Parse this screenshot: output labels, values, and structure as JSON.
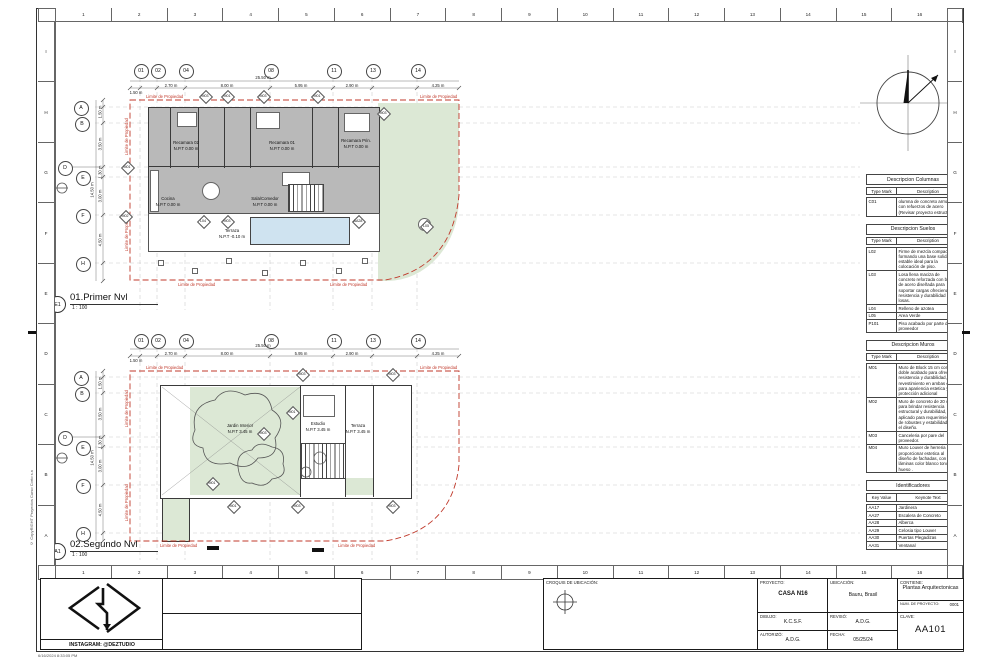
{
  "sheet": {
    "ruler_numbers": [
      "1",
      "2",
      "3",
      "4",
      "5",
      "6",
      "7",
      "8",
      "9",
      "10",
      "11",
      "12",
      "13",
      "14",
      "15",
      "16"
    ],
    "ruler_letters": [
      "I",
      "H",
      "G",
      "F",
      "E",
      "D",
      "C",
      "B",
      "A"
    ],
    "copyright": "© CopyRIGHT Proyectos Curso Corto s.n",
    "timestamp": "6/16/2024 8:33:05 PM"
  },
  "plan1": {
    "ref": "E1",
    "title": "01.Primer Nvl",
    "scale": "1 : 100",
    "cols": [
      "01",
      "02",
      "04",
      "08",
      "11",
      "13",
      "14"
    ],
    "rows": [
      "A",
      "B",
      "D",
      "E",
      "F",
      "H"
    ],
    "dims_top": [
      "1.50 m",
      "2.70 m",
      "8.00 m",
      "5.95 m",
      "2.90 m",
      "4.25 m"
    ],
    "dim_top_total": "25.50 m",
    "dims_left": [
      "1.50 m",
      "3.50 m",
      "1.30 m",
      "3.00 m",
      "4.50 m"
    ],
    "dim_left_total": "14.50 m",
    "property_label": "Limite de Propiedad",
    "rooms": [
      {
        "name": "Recamara 02",
        "level": "N.P.T 0.00 m"
      },
      {
        "name": "Recamara 01",
        "level": "N.P.T 0.00 m"
      },
      {
        "name": "Recamara Prin.",
        "level": "N.P.T 0.00 m"
      },
      {
        "name": "Cocina",
        "level": "N.P.T 0.00 m"
      },
      {
        "name": "Sala/Comedor",
        "level": "N.P.T 0.00 m"
      },
      {
        "name": "Terraza",
        "level": "N.P.T -0.10 m"
      }
    ],
    "tags": [
      "M03",
      "M01",
      "M03",
      "M01",
      "M03",
      "M01",
      "M02",
      "L04",
      "M03",
      "AA28",
      "L05"
    ]
  },
  "plan2": {
    "ref": "A1",
    "title": "02.Segundo Nvl",
    "scale": "1 : 100",
    "cols": [
      "01",
      "02",
      "04",
      "08",
      "11",
      "13",
      "14"
    ],
    "rows": [
      "A",
      "B",
      "D",
      "E",
      "F",
      "H"
    ],
    "dims_top": [
      "1.50 m",
      "2.70 m",
      "8.00 m",
      "5.95 m",
      "2.90 m",
      "4.25 m"
    ],
    "dim_top_total": "25.50 m",
    "dims_left": [
      "1.50 m",
      "3.50 m",
      "1.30 m",
      "3.00 m",
      "4.50 m"
    ],
    "dim_left_total": "14.50 m",
    "property_label": "Limite de Propiedad",
    "rooms": [
      {
        "name": "Jardin Interior",
        "level": "N.P.T 3.45 m"
      },
      {
        "name": "Estudio",
        "level": "N.P.T 3.45 m"
      },
      {
        "name": "Terraza",
        "level": "N.P.T 3.45 m"
      }
    ],
    "tags": [
      "M03",
      "M03",
      "M01",
      "M03",
      "M01",
      "M01",
      "M03",
      "M03"
    ]
  },
  "tables": {
    "columnas": {
      "title": "Descripcion Columnas",
      "headers": [
        "Type Mark",
        "Description"
      ],
      "rows": [
        [
          "C01",
          "olumna de concreto armado con refuerzos de acero (Revisar proyecto estructural)."
        ]
      ]
    },
    "suelos": {
      "title": "Descripcion Suelos",
      "headers": [
        "Type Mark",
        "Description"
      ],
      "rows": [
        [
          "L02",
          "Firme de mezcla compactada, formando una base solida y estable ideal para la colocación de piso."
        ],
        [
          "L03",
          "Losa llena maciza de concreto reforzada con barras de acero diseñada para soportar cargas ofreciendo resistencia y durabilidad en losas."
        ],
        [
          "L04",
          "Relleno de azotea"
        ],
        [
          "L05",
          "Area Verde"
        ],
        [
          "P101",
          "Piso acabado por parte de proveedor"
        ]
      ]
    },
    "muros": {
      "title": "Descripcion Muros",
      "headers": [
        "Type Mark",
        "Description"
      ],
      "rows": [
        [
          "M01",
          "Muro de Block 15 cm con doble acabado para ofrecer resistencia y durabilidad, con revestimiento en ambas caras para apariencia estetica y protección adicional"
        ],
        [
          "M02",
          "Muro de concreto de 20 cms para brindar resistencia estructural y durabilidad, es aplicado para requerimientos de robustes y estabilidad en el diseño."
        ],
        [
          "M03",
          "Canceleria por pare del proveedor."
        ],
        [
          "M04",
          "Muro Louver de herreria para proporcionar estetica al diseño de fachadas, con láminas color blanco tono hueso ."
        ]
      ]
    },
    "identificadores": {
      "title": "Identificadores",
      "headers": [
        "Key Value",
        "Keynote Text"
      ],
      "rows": [
        [
          "AA17",
          "Jardinera"
        ],
        [
          "AA27",
          "Escalera de Concreto"
        ],
        [
          "AA28",
          "Alberca"
        ],
        [
          "AA29",
          "Celosia tipo Louver"
        ],
        [
          "AA30",
          "Puertas Plegadizas"
        ],
        [
          "AA31",
          "Ventanal"
        ]
      ]
    }
  },
  "titleblock": {
    "croquis_label": "CROQUIS DE UBICACIÓN:",
    "proyecto_label": "PROYECTO:",
    "proyecto_value": "CASA N16",
    "ubicacion_label": "UBICACIÓN:",
    "ubicacion_value": "Bauru, Brasil",
    "contiene_label": "CONTIENE:",
    "contiene_value": "Plantas Arquitectonicas",
    "num_label": "NUM. DE PROYECTO:",
    "num_value": "0001",
    "dibujo_label": "DIBUJO:",
    "dibujo_value": "K.C.S.F.",
    "reviso_label": "REVISÓ:",
    "reviso_value": "A.D.G.",
    "autorizo_label": "AUTORIZÓ:",
    "autorizo_value": "A.D.G.",
    "fecha_label": "FECHA:",
    "fecha_value": "05/25/24",
    "clave_label": "CLAVE:",
    "clave_value": "AA101",
    "instagram": "INSTAGRAM: @DEZTUDIO"
  }
}
